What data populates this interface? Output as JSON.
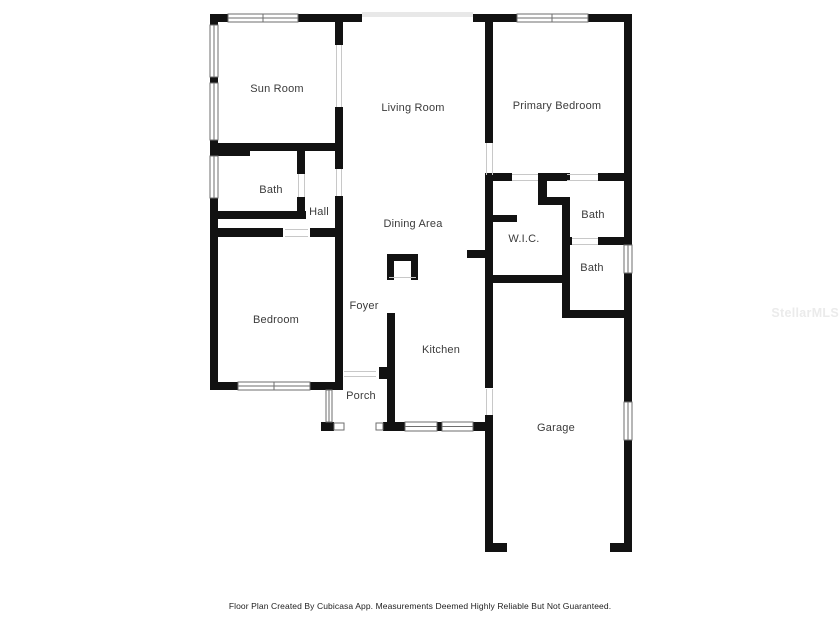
{
  "rooms": {
    "sun_room": {
      "label": "Sun Room"
    },
    "living_room": {
      "label": "Living Room"
    },
    "primary_bedroom": {
      "label": "Primary Bedroom"
    },
    "bath_left": {
      "label": "Bath"
    },
    "hall": {
      "label": "Hall"
    },
    "dining_area": {
      "label": "Dining Area"
    },
    "wic": {
      "label": "W.I.C."
    },
    "bath_upper_right": {
      "label": "Bath"
    },
    "bath_lower_right": {
      "label": "Bath"
    },
    "bedroom": {
      "label": "Bedroom"
    },
    "foyer": {
      "label": "Foyer"
    },
    "kitchen": {
      "label": "Kitchen"
    },
    "porch": {
      "label": "Porch"
    },
    "garage": {
      "label": "Garage"
    }
  },
  "footer": {
    "disclaimer": "Floor Plan Created By Cubicasa App. Measurements Deemed Highly Reliable But Not Guaranteed."
  },
  "watermark": {
    "text": "StellarMLS"
  },
  "colors": {
    "wall": "#121212",
    "window_stroke": "#6e6e6e",
    "opening_line": "#c8c8c8",
    "faint_opening": "#e8e8e8",
    "label": "#3b3b3b",
    "footer": "#1e1e1e",
    "watermark": "#ebebeb",
    "background": "#ffffff"
  }
}
